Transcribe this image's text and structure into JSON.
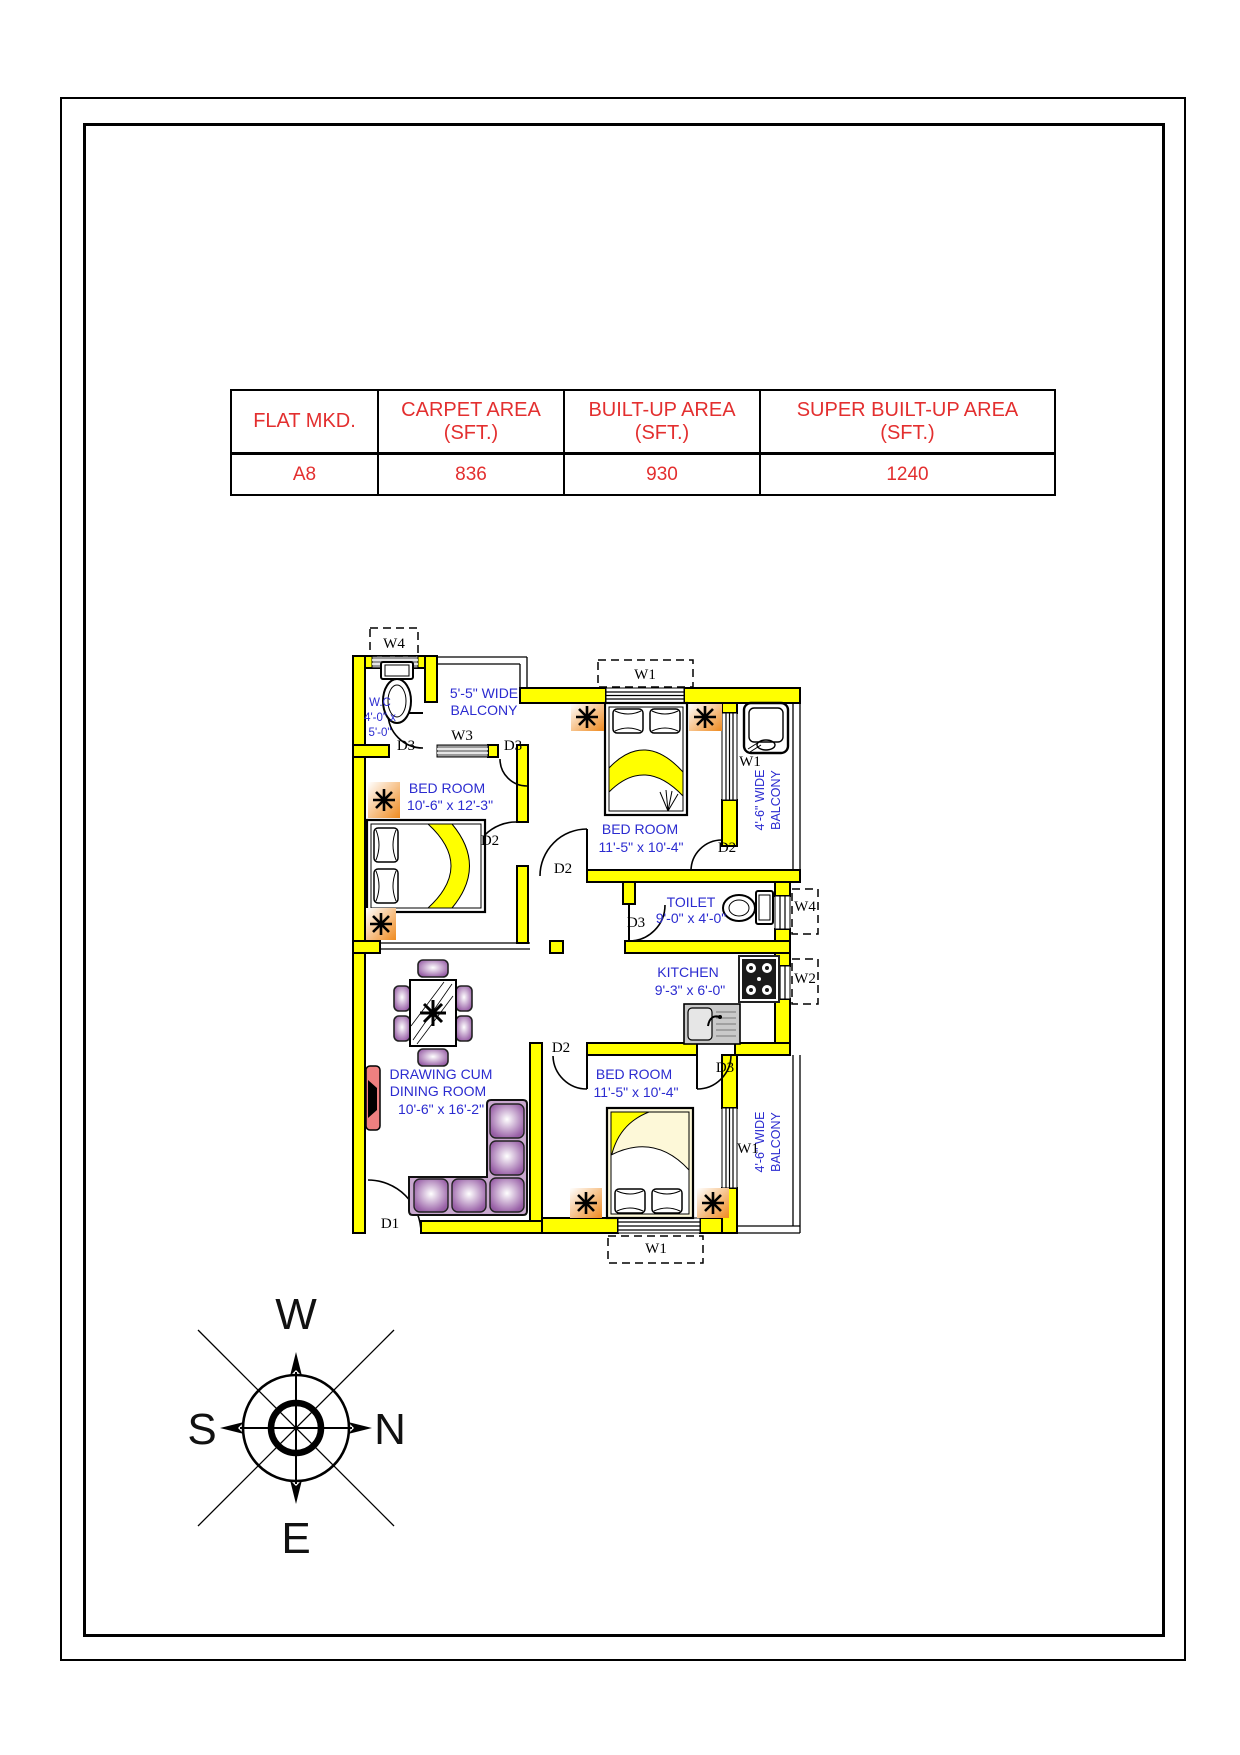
{
  "area_table": {
    "columns": [
      {
        "header_line1": "FLAT MKD.",
        "header_line2": "",
        "value": "A8"
      },
      {
        "header_line1": "CARPET AREA",
        "header_line2": "(SFT.)",
        "value": "836"
      },
      {
        "header_line1": "BUILT-UP AREA",
        "header_line2": "(SFT.)",
        "value": "930"
      },
      {
        "header_line1": "SUPER BUILT-UP AREA",
        "header_line2": "(SFT.)",
        "value": "1240"
      }
    ]
  },
  "floor_plan": {
    "rooms": {
      "wc": {
        "name": "W.C",
        "dim1": "4'-0\" x",
        "dim2": "5'-0\""
      },
      "balcony_top": {
        "line1": "5'-5\" WIDE",
        "line2": "BALCONY"
      },
      "bedroom_left": {
        "name": "BED ROOM",
        "dims": "10'-6\" x 12'-3\""
      },
      "bedroom_top_right": {
        "name": "BED ROOM",
        "dims": "11'-5\" x 10'-4\""
      },
      "toilet": {
        "name": "TOILET",
        "dims": "9'-0\" x 4'-0\""
      },
      "kitchen": {
        "name": "KITCHEN",
        "dims": "9'-3\" x 6'-0\""
      },
      "drawing_dining": {
        "line1": "DRAWING CUM",
        "line2": "DINING ROOM",
        "dims": "10'-6\" x 16'-2\""
      },
      "bedroom_bottom": {
        "name": "BED ROOM",
        "dims": "11'-5\" x 10'-4\""
      },
      "balcony_right_top": {
        "line1": "4'-6\" WIDE",
        "line2": "BALCONY"
      },
      "balcony_right_bottom": {
        "line1": "4'-6\" WIDE",
        "line2": "BALCONY"
      }
    },
    "door_labels": {
      "d1": "D1",
      "d2": "D2",
      "d3": "D3"
    },
    "window_labels": {
      "w1": "W1",
      "w2": "W2",
      "w3": "W3",
      "w4": "W4"
    }
  },
  "compass": {
    "top": "W",
    "right": "N",
    "left": "S",
    "bottom": "E"
  },
  "colors": {
    "wall": "#ffff00",
    "room_label_blue": "#2b2bd0",
    "table_text_red": "#e32f2f",
    "furniture_purple": "#9a62a8",
    "side_table_orange": "#ef8a1f",
    "tv_unit_red": "#ef8080"
  }
}
